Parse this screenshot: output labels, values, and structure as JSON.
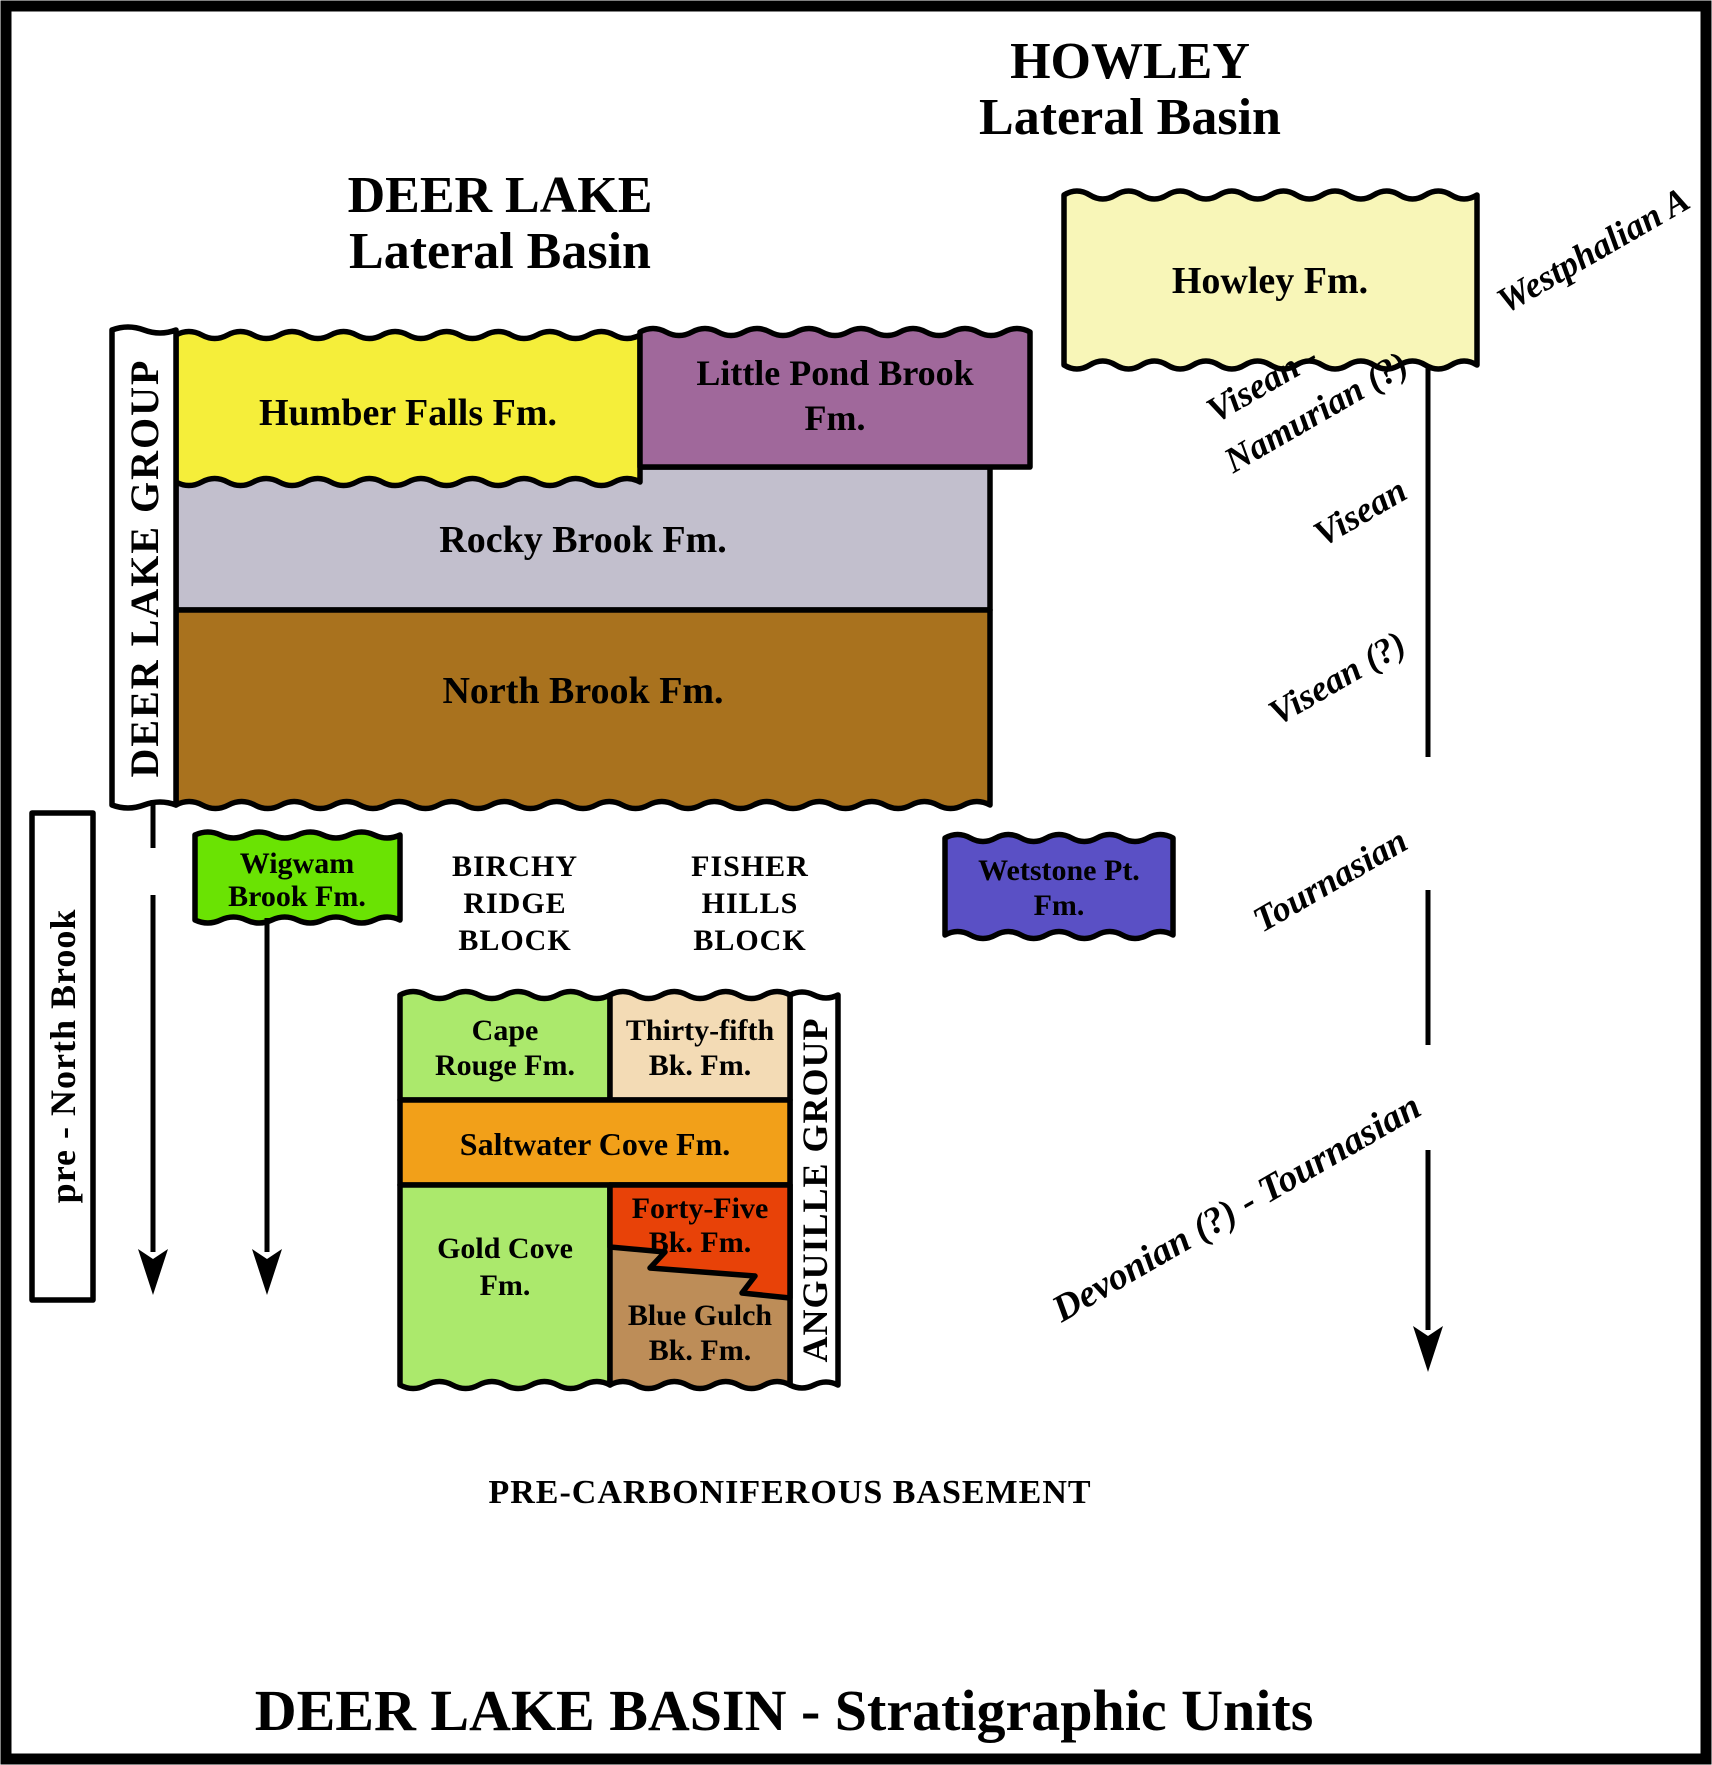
{
  "headers": {
    "deer_lake": [
      "DEER LAKE",
      "Lateral Basin"
    ],
    "howley": [
      "HOWLEY",
      "Lateral Basin"
    ]
  },
  "groups": {
    "deer_lake_group": "DEER LAKE GROUP",
    "anguille_group": "ANGUILLE GROUP",
    "pre_north_brook": "pre - North Brook"
  },
  "blocks": {
    "birchy_ridge": [
      "BIRCHY",
      "RIDGE",
      "BLOCK"
    ],
    "fisher_hills": [
      "FISHER",
      "HILLS",
      "BLOCK"
    ]
  },
  "formations": {
    "howley": {
      "lines": [
        "Howley Fm."
      ],
      "color": "#f8f6b8"
    },
    "humber_falls": {
      "lines": [
        "Humber Falls Fm."
      ],
      "color": "#f5ee3a"
    },
    "little_pond": {
      "lines": [
        "Little Pond Brook",
        "Fm."
      ],
      "color": "#a0689b"
    },
    "rocky_brook": {
      "lines": [
        "Rocky Brook Fm."
      ],
      "color": "#c2bfcd"
    },
    "north_brook": {
      "lines": [
        "North Brook Fm."
      ],
      "color": "#a9721e"
    },
    "wigwam": {
      "lines": [
        "Wigwam",
        "Brook Fm."
      ],
      "color": "#6ae303"
    },
    "wetstone": {
      "lines": [
        "Wetstone Pt.",
        "Fm."
      ],
      "color": "#5a50c5"
    },
    "cape_rouge": {
      "lines": [
        "Cape",
        "Rouge Fm."
      ],
      "color": "#abe96c"
    },
    "thirty_fifth": {
      "lines": [
        "Thirty-fifth",
        "Bk. Fm."
      ],
      "color": "#f3dbb5"
    },
    "saltwater": {
      "lines": [
        "Saltwater Cove Fm."
      ],
      "color": "#f2a019"
    },
    "gold_cove": {
      "lines": [
        "Gold Cove",
        "Fm."
      ],
      "color": "#abe96c"
    },
    "forty_five": {
      "lines": [
        "Forty-Five",
        "Bk. Fm."
      ],
      "color": "#e84208"
    },
    "blue_gulch": {
      "lines": [
        "Blue Gulch",
        "Bk. Fm."
      ],
      "color": "#bd8d58"
    }
  },
  "time_labels": {
    "westphalian_a": "Westphalian A",
    "visean_namurian": [
      "Visean -",
      "Namurian (?)"
    ],
    "visean": "Visean",
    "visean_q": "Visean (?)",
    "tournasian": "Tournasian",
    "devonian_tournasian": "Devonian (?) - Tournasian"
  },
  "basement_label": "PRE-CARBONIFEROUS BASEMENT",
  "bottom_title": "DEER LAKE BASIN - Stratigraphic Units",
  "colors": {
    "label_box": "#ffffff",
    "ink": "#000000",
    "background": "#ffffff"
  }
}
